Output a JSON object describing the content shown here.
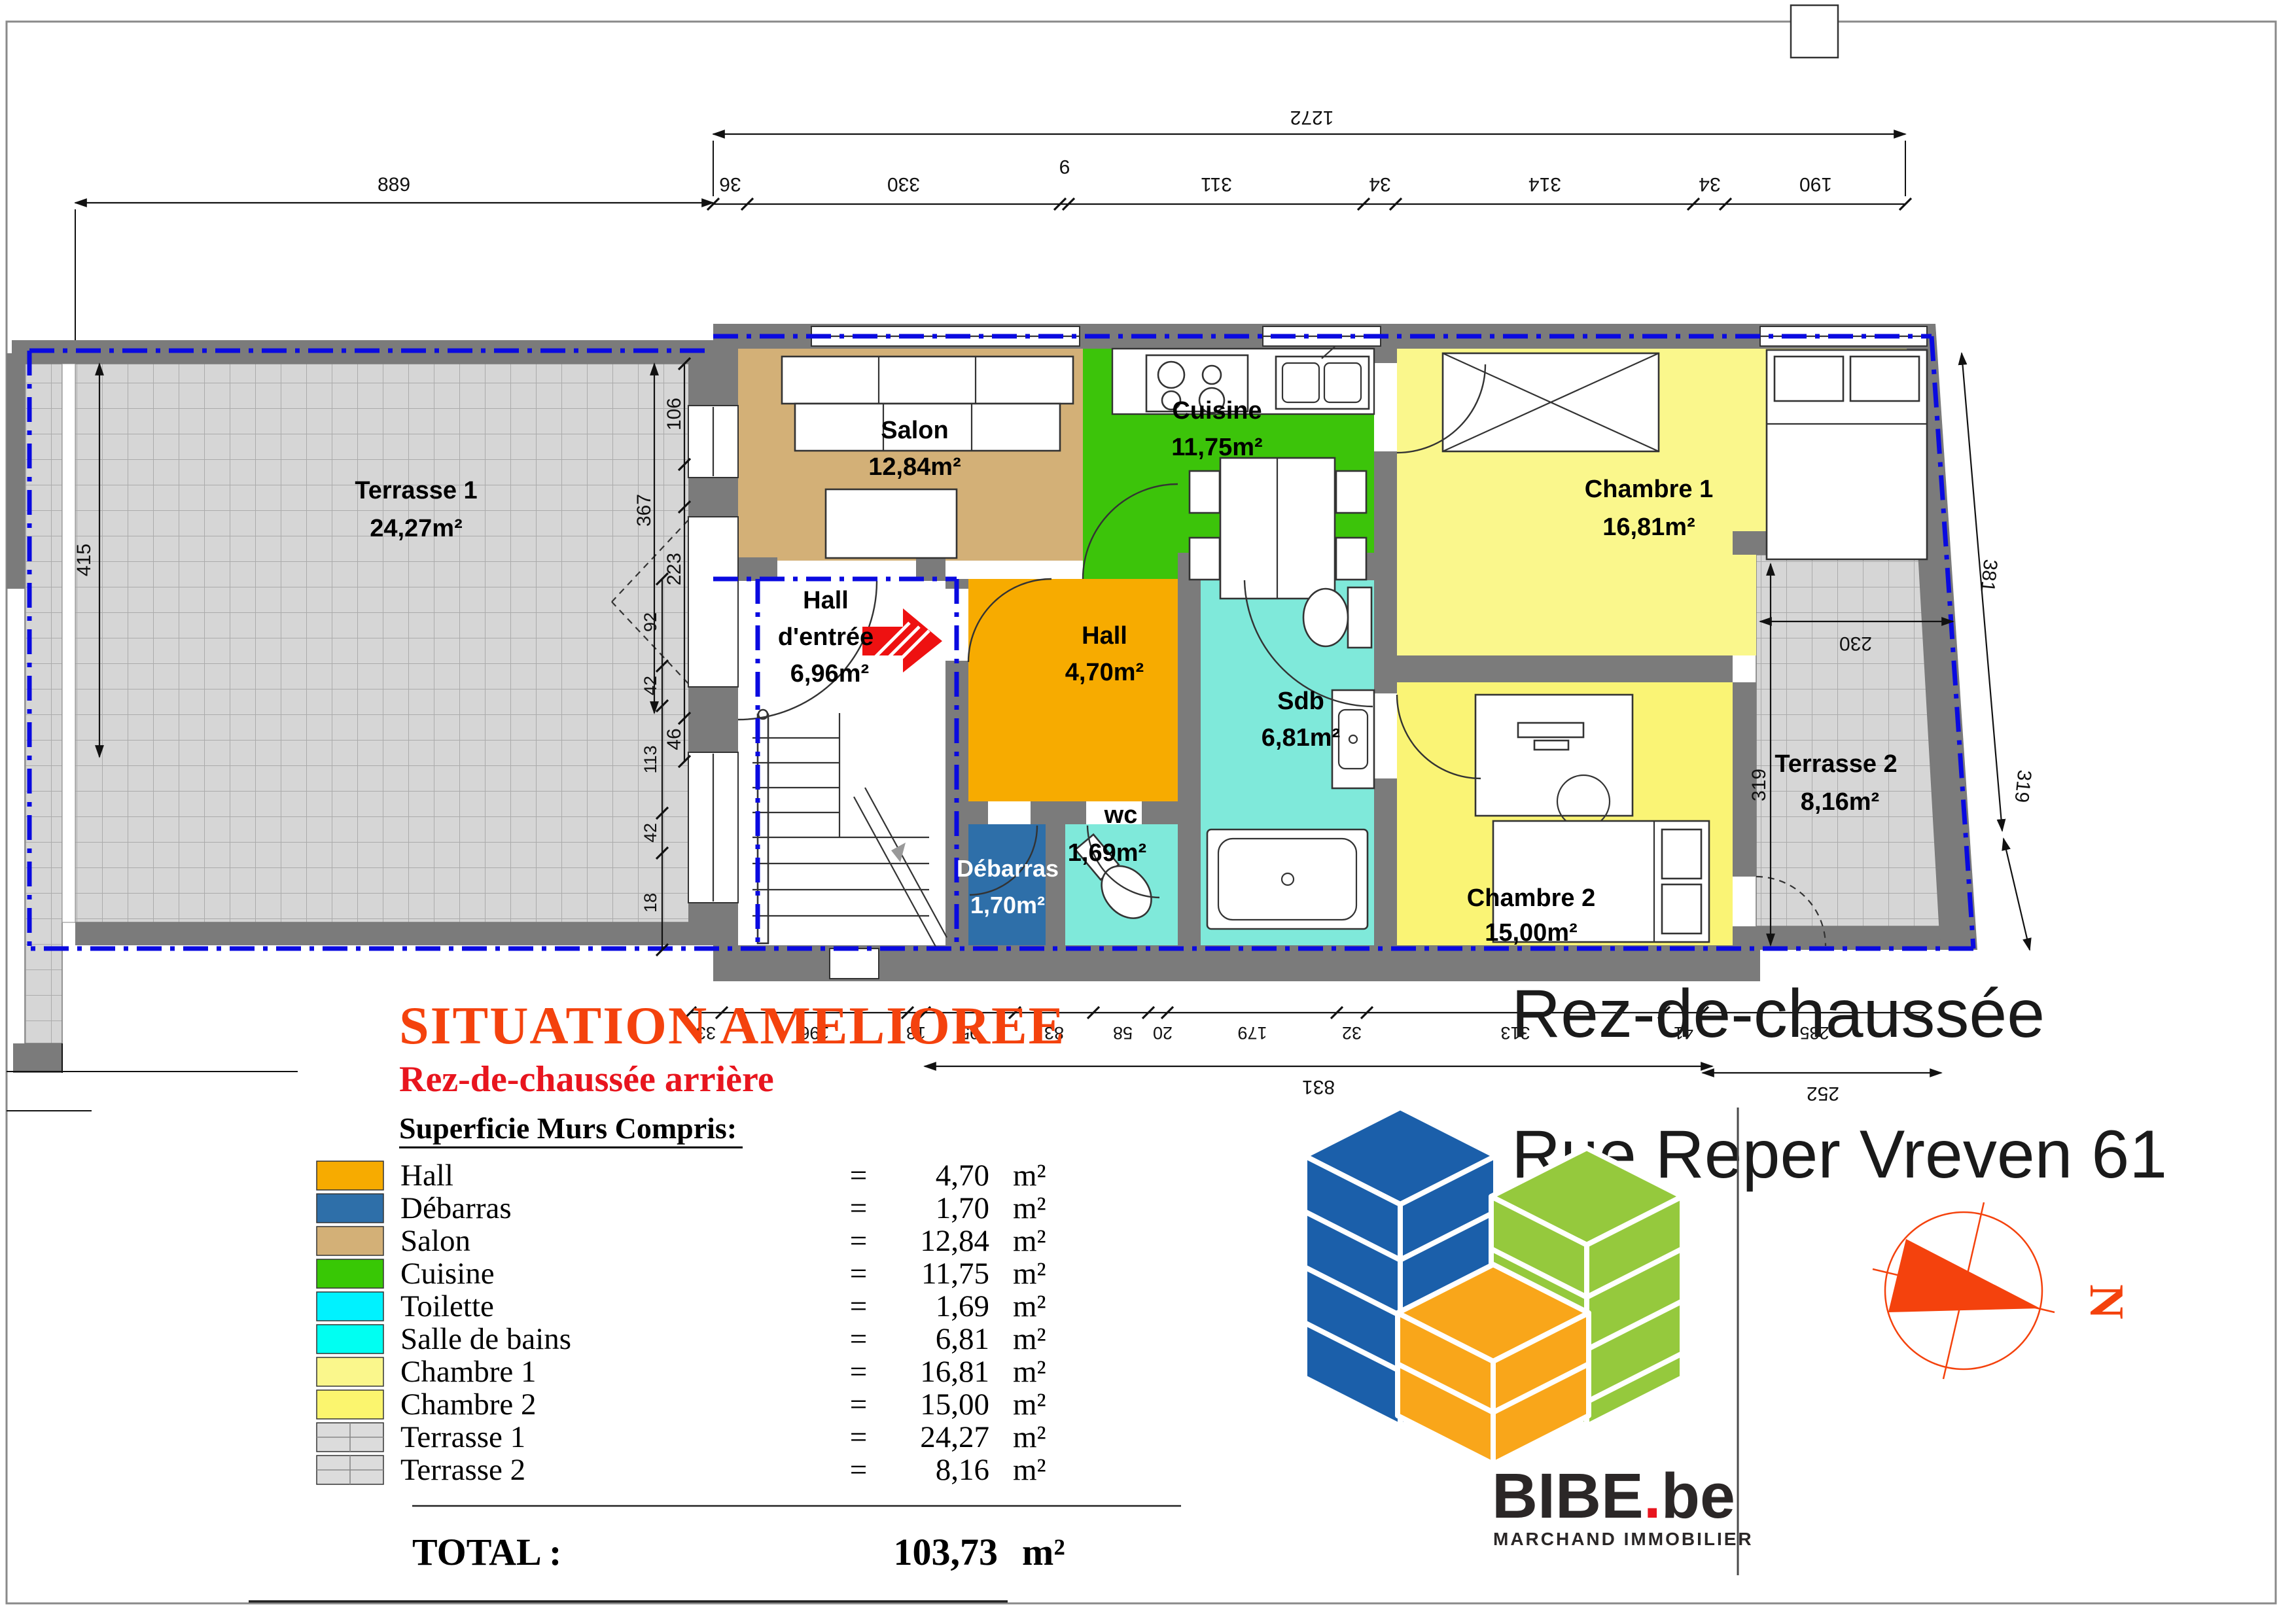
{
  "plan": {
    "rooms": {
      "terrasse1": {
        "name": "Terrasse 1",
        "area": "24,27m²"
      },
      "salon": {
        "name": "Salon",
        "area": "12,84m²"
      },
      "cuisine": {
        "name": "Cuisine",
        "area": "11,75m²"
      },
      "chambre1": {
        "name": "Chambre 1",
        "area": "16,81m²"
      },
      "chambre2": {
        "name": "Chambre 2",
        "area": "15,00m²"
      },
      "hall_entree": {
        "name1": "Hall",
        "name2": "d'entrée",
        "area": "6,96m²"
      },
      "hall": {
        "name": "Hall",
        "area": "4,70m²"
      },
      "wc": {
        "name": "wc",
        "area": "1,69m²"
      },
      "debarras": {
        "name": "Débarras",
        "area": "1,70m²"
      },
      "sdb": {
        "name": "Sdb",
        "area": "6,81m²"
      },
      "terrasse2": {
        "name": "Terrasse 2",
        "area": "8,16m²"
      }
    },
    "dims": {
      "top_total": "1272",
      "top_chain": [
        "36",
        "330",
        "9",
        "311",
        "34",
        "314",
        "34",
        "190"
      ],
      "left_top": "889",
      "left_outer": "415",
      "mid_chain": [
        "106",
        "367",
        "223",
        "46"
      ],
      "left_lower": [
        "92",
        "42",
        "113",
        "42",
        "18"
      ],
      "right_chain": [
        "381",
        "319"
      ],
      "terr2_w": "230",
      "terr2_h": "319",
      "bottom_chain": [
        "33",
        "196",
        "18",
        "95",
        "83",
        "58",
        "20",
        "179",
        "32",
        "313",
        "41",
        "235"
      ],
      "bottom_totals": [
        "831",
        "252"
      ]
    },
    "floor_label": "Rez-de-chaussée",
    "address": "Rue Reper Vreven 61"
  },
  "legend": {
    "title": "SITUATION AMELIOREE",
    "subtitle": "Rez-de-chaussée arrière",
    "heading": "Superficie Murs Compris:",
    "equals": "=",
    "unit": "m²",
    "rows": [
      {
        "label": "Hall",
        "value": "4,70",
        "color": "#F7AB00",
        "hatch": false
      },
      {
        "label": "Débarras",
        "value": "1,70",
        "color": "#2E6FA9",
        "hatch": false
      },
      {
        "label": "Salon",
        "value": "12,84",
        "color": "#D3B077",
        "hatch": false
      },
      {
        "label": "Cuisine",
        "value": "11,75",
        "color": "#38C805",
        "hatch": false
      },
      {
        "label": "Toilette",
        "value": "1,69",
        "color": "#00F2FF",
        "hatch": false
      },
      {
        "label": "Salle de bains",
        "value": "6,81",
        "color": "#00FFF2",
        "hatch": false
      },
      {
        "label": "Chambre 1",
        "value": "16,81",
        "color": "#FAF78C",
        "hatch": false
      },
      {
        "label": "Chambre 2",
        "value": "15,00",
        "color": "#FBF56E",
        "hatch": false
      },
      {
        "label": "Terrasse 1",
        "value": "24,27",
        "color": "#DCDCDC",
        "hatch": true
      },
      {
        "label": "Terrasse 2",
        "value": "8,16",
        "color": "#DCDCDC",
        "hatch": true
      }
    ],
    "total_label": "TOTAL :",
    "total_value": "103,73",
    "total_unit": "m²"
  },
  "logo": {
    "name": "BIBE",
    "dot": ".",
    "tld": "be",
    "tagline": "MARCHAND IMMOBILIER"
  },
  "compass": {
    "label": "N"
  },
  "colors": {
    "wall": "#7B7B7B",
    "terrace": "#D6D6D6",
    "salon": "#D3B077",
    "cuisine": "#3CC40A",
    "hall": "#F7AB00",
    "debarras": "#2E6FA9",
    "wc": "#7FE9DA",
    "sdb": "#7FE9DA",
    "chambre1": "#FAF78C",
    "chambre2": "#FAF475",
    "boundary": "#0A0AE0",
    "title": "#F4420D",
    "subtitle": "#E8151E",
    "logo_blue": "#1B5FAA",
    "logo_green": "#95C93D",
    "logo_orange": "#F9A61A",
    "logo_dot": "#E8151E",
    "compass": "#F4420D",
    "arrow": "#EE1111"
  }
}
